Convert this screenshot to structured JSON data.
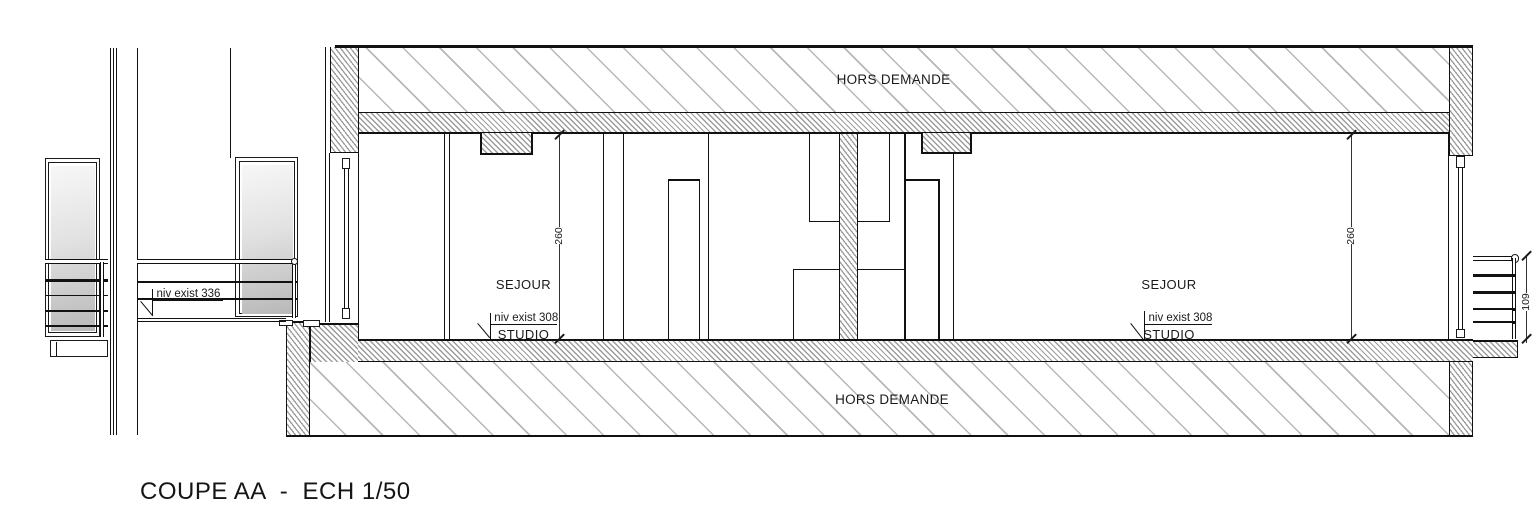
{
  "title": {
    "label": "COUPE AA  -  ECH 1/50"
  },
  "zones": {
    "top": "HORS DEMANDE",
    "bottom": "HORS DEMANDE"
  },
  "rooms": [
    {
      "line1": "SEJOUR",
      "line2": "STUDIO",
      "height": "260",
      "level": "niv exist 308"
    },
    {
      "line1": "SEJOUR",
      "line2": "STUDIO",
      "height": "260",
      "level": "niv exist 308"
    }
  ],
  "levels": {
    "balcony": "niv exist 336"
  },
  "dims": {
    "railing": "109"
  },
  "colors": {
    "line": "#1a1a1a",
    "hatch_dense": "#9c9c9c",
    "hatch_light": "#b7b7b7"
  }
}
